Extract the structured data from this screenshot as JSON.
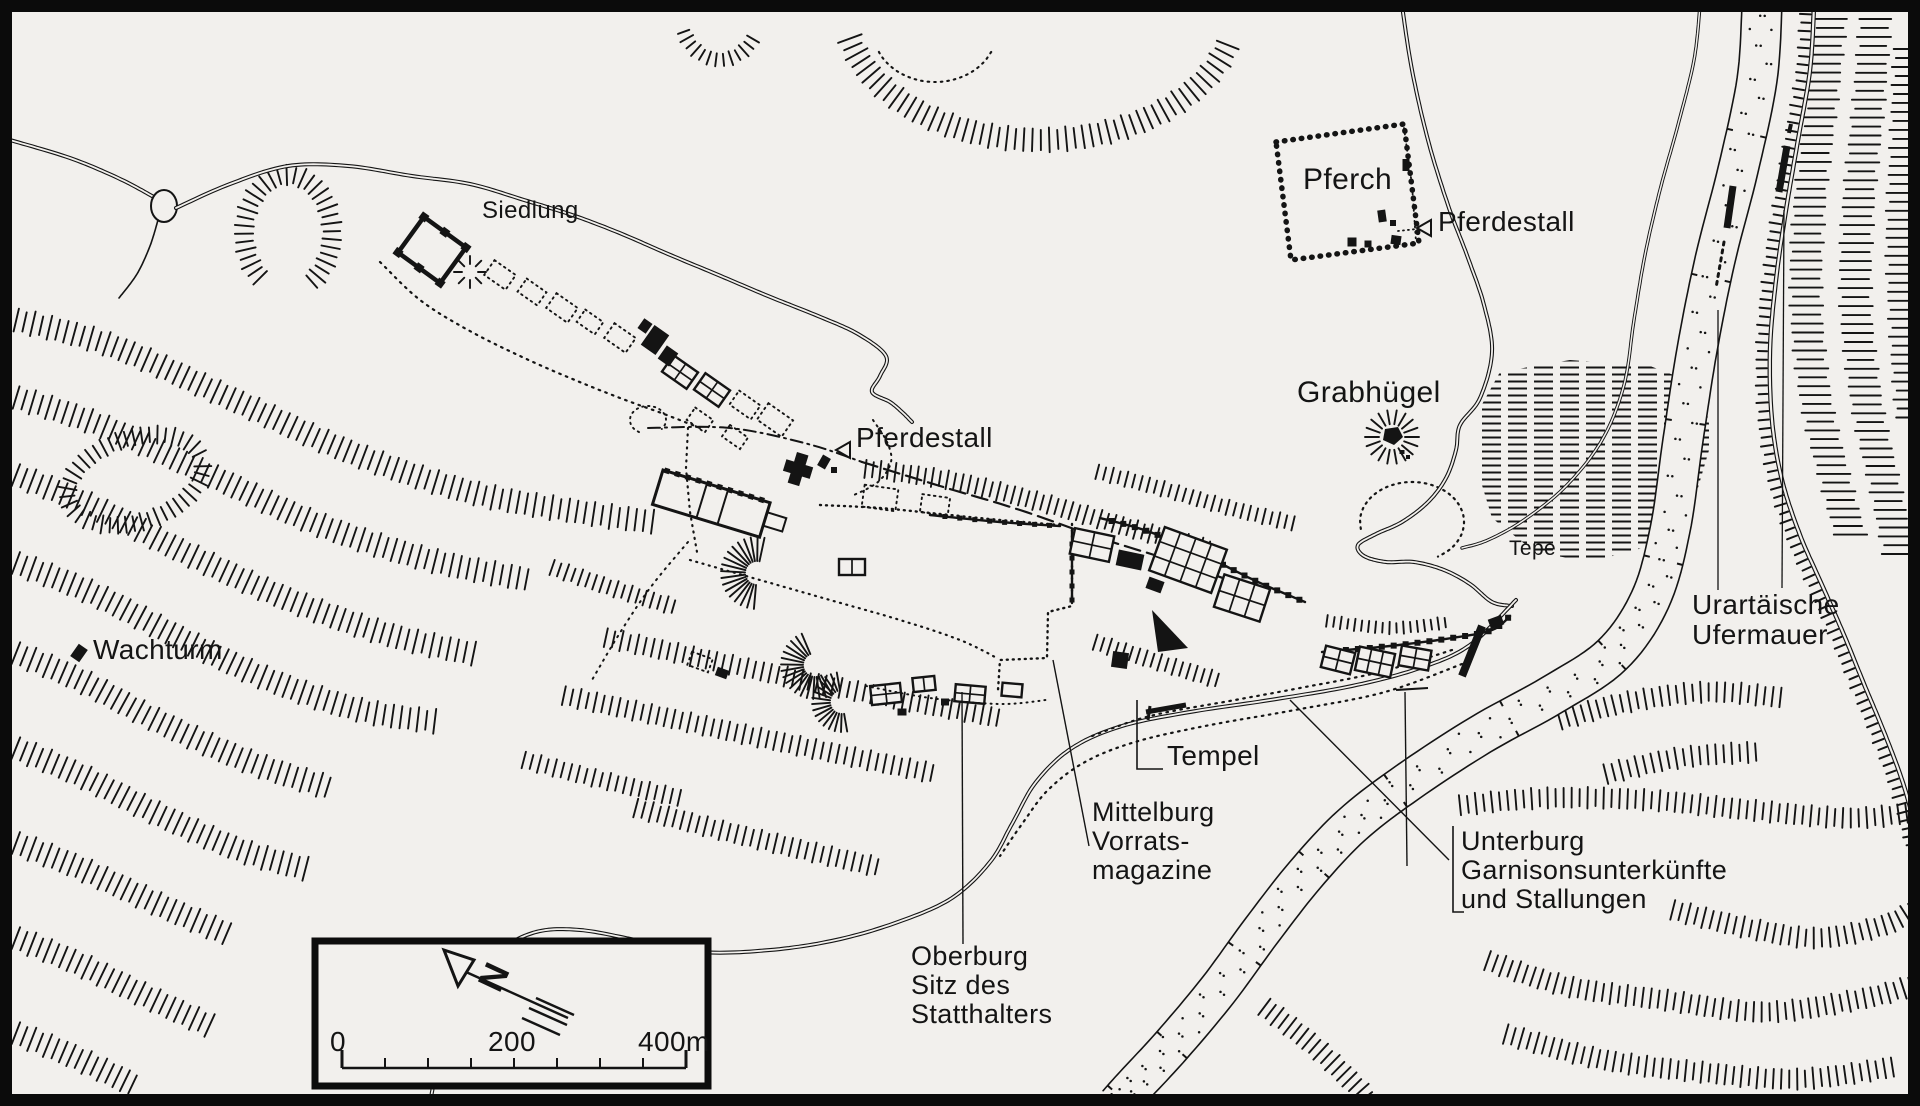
{
  "map": {
    "labels": {
      "siedlung": "Siedlung",
      "pferch": "Pferch",
      "pferdestall_top": "Pferdestall",
      "pferdestall_mid": "Pferdestall",
      "grabhuegel": "Grabhügel",
      "tepe": "Tepe",
      "ufermauer_line1": "Urartäische",
      "ufermauer_line2": "Ufermauer",
      "wachturm": "Wachturm",
      "tempel": "Tempel",
      "mittelburg_line1": "Mittelburg",
      "mittelburg_line2": "Vorrats-",
      "mittelburg_line3": "magazine",
      "oberburg_line1": "Oberburg",
      "oberburg_line2": "Sitz des",
      "oberburg_line3": "Statthalters",
      "unterburg_line1": "Unterburg",
      "unterburg_line2": "Garnisonsunterkünfte",
      "unterburg_line3": "und Stallungen"
    },
    "scale_bar": {
      "tick0": "0",
      "tick200": "200",
      "tick400": "400m"
    },
    "compass": {
      "north": "N"
    },
    "colors": {
      "ink": "#141414",
      "paper": "#f2f0ed"
    }
  }
}
